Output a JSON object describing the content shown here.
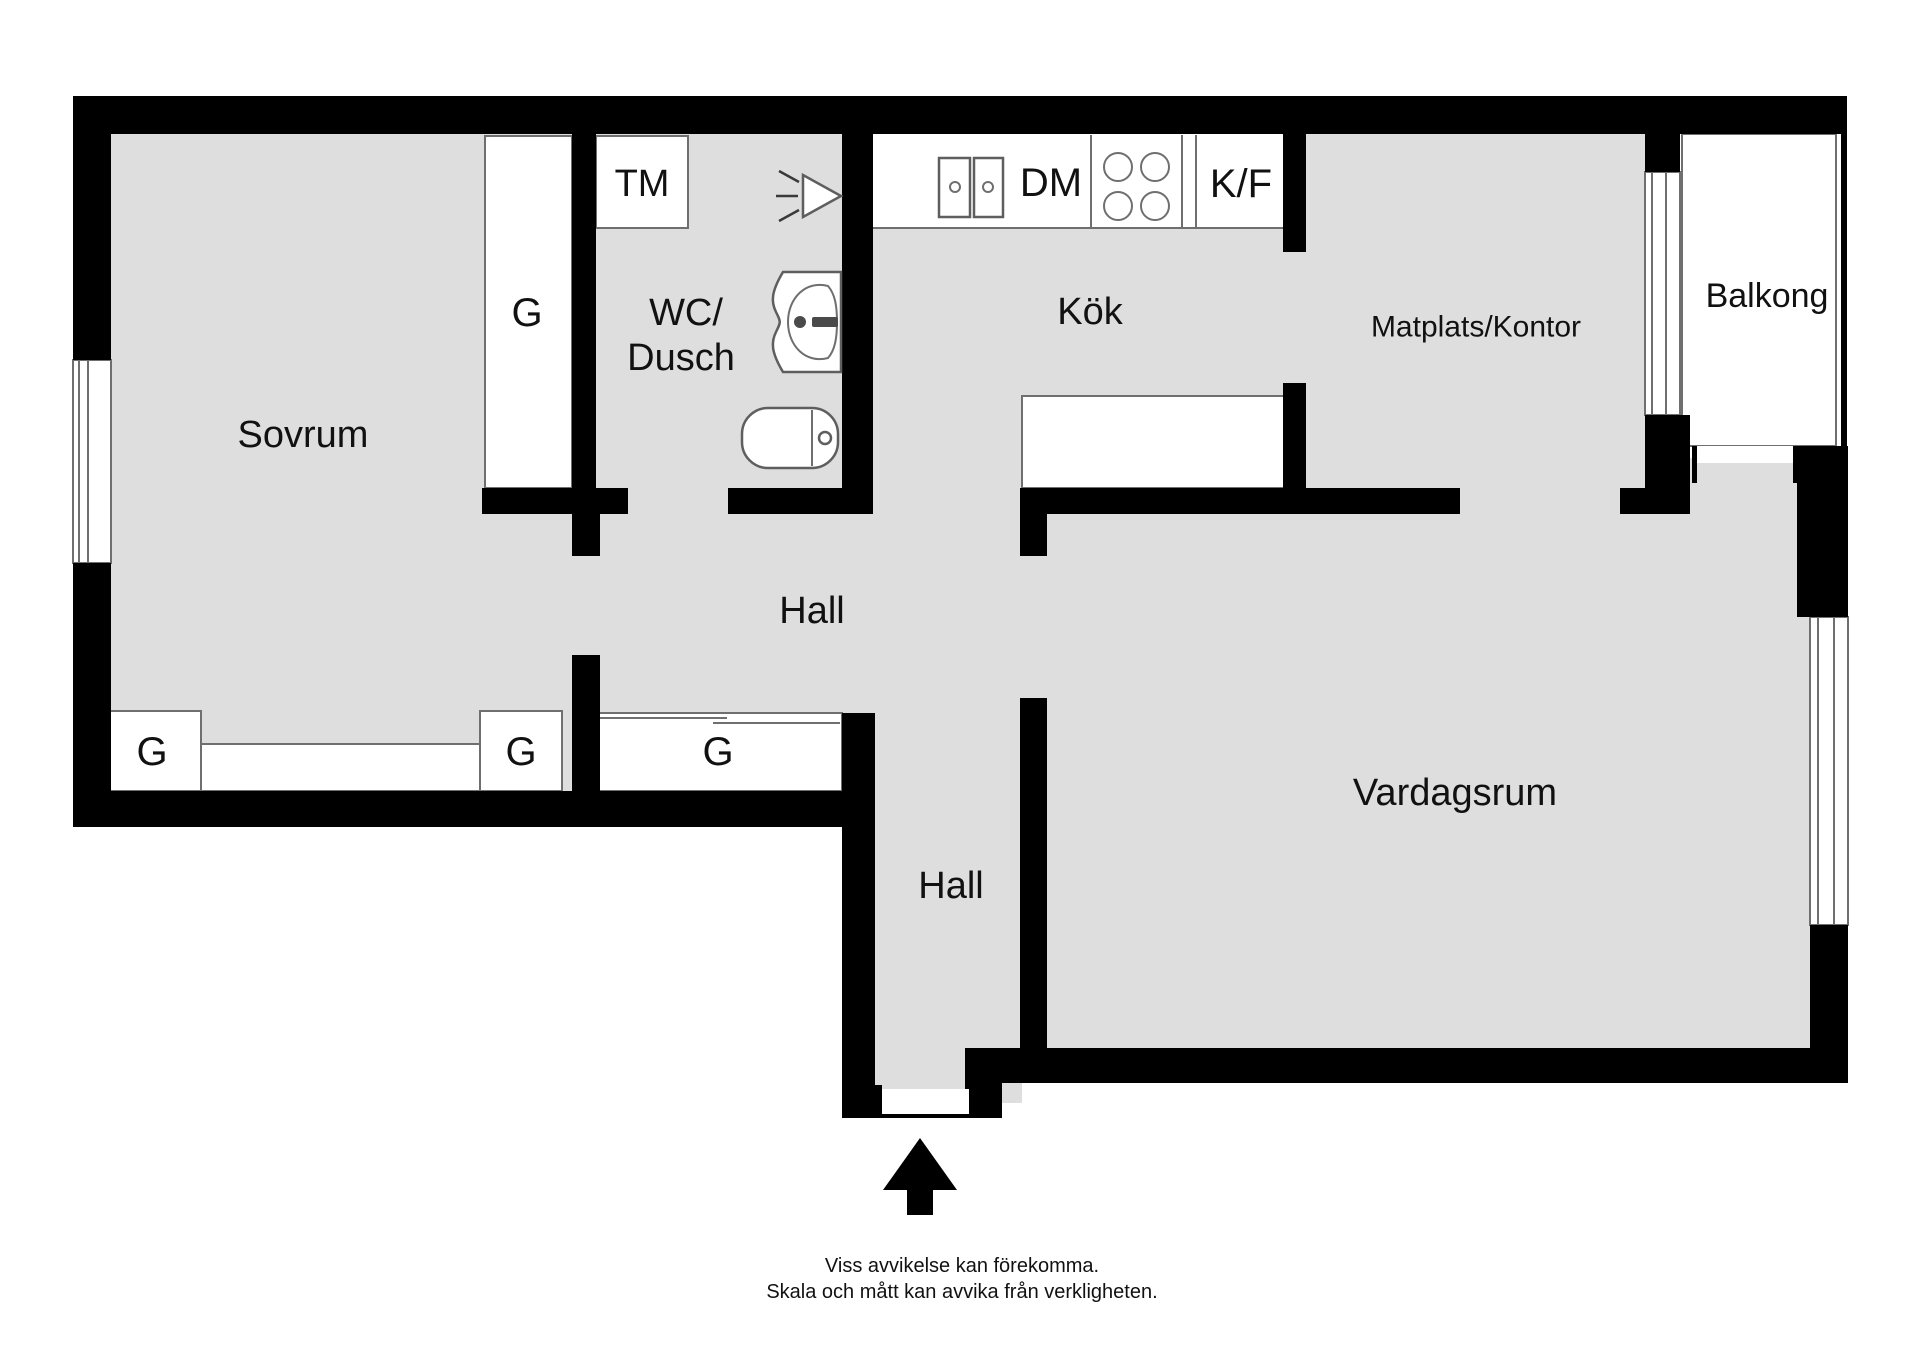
{
  "plan": {
    "rooms": {
      "sovrum": "Sovrum",
      "wc_dusch_line1": "WC/",
      "wc_dusch_line2": "Dusch",
      "kok": "Kök",
      "matplats_kontor": "Matplats/Kontor",
      "balkong": "Balkong",
      "hall_upper": "Hall",
      "hall_lower": "Hall",
      "vardagsrum": "Vardagsrum"
    },
    "closets": {
      "tall": "G",
      "left": "G",
      "middle": "G",
      "hall": "G"
    },
    "appliances": {
      "washing_machine": "TM",
      "dishwasher": "DM",
      "fridge_freezer": "K/F"
    },
    "footer": {
      "line1": "Viss avvikelse kan förekomma.",
      "line2": "Skala och mått kan avvika från verkligheten."
    },
    "colors": {
      "wall": "#000000",
      "floor": "#dedede",
      "outline": "#6f6f6f",
      "background": "#ffffff",
      "label": "#111111"
    }
  }
}
